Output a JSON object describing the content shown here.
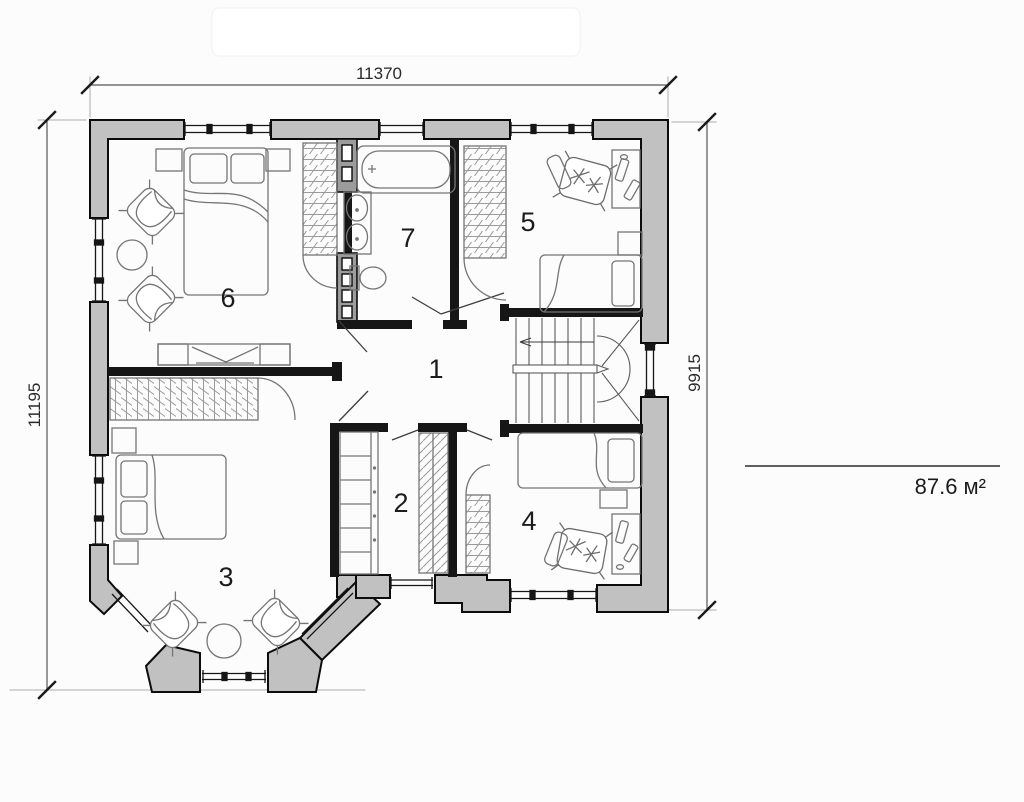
{
  "plan": {
    "dimensions": {
      "top": "11370",
      "left": "11195",
      "right": "9915"
    },
    "area": {
      "value": "87.6 м²"
    },
    "rooms": [
      {
        "id": "hall",
        "number": "1"
      },
      {
        "id": "walk-in-closet",
        "number": "2"
      },
      {
        "id": "bedroom-left",
        "number": "3"
      },
      {
        "id": "room-bottom-right",
        "number": "4"
      },
      {
        "id": "room-top-right",
        "number": "5"
      },
      {
        "id": "bedroom-top-left",
        "number": "6"
      },
      {
        "id": "bathroom",
        "number": "7"
      }
    ]
  },
  "colors": {
    "wall_fill": "#c1c1c1",
    "wall_stroke": "#0c0c0c",
    "interior_wall": "#161616",
    "furniture_line": "#757575",
    "dimension_line": "#555555"
  }
}
